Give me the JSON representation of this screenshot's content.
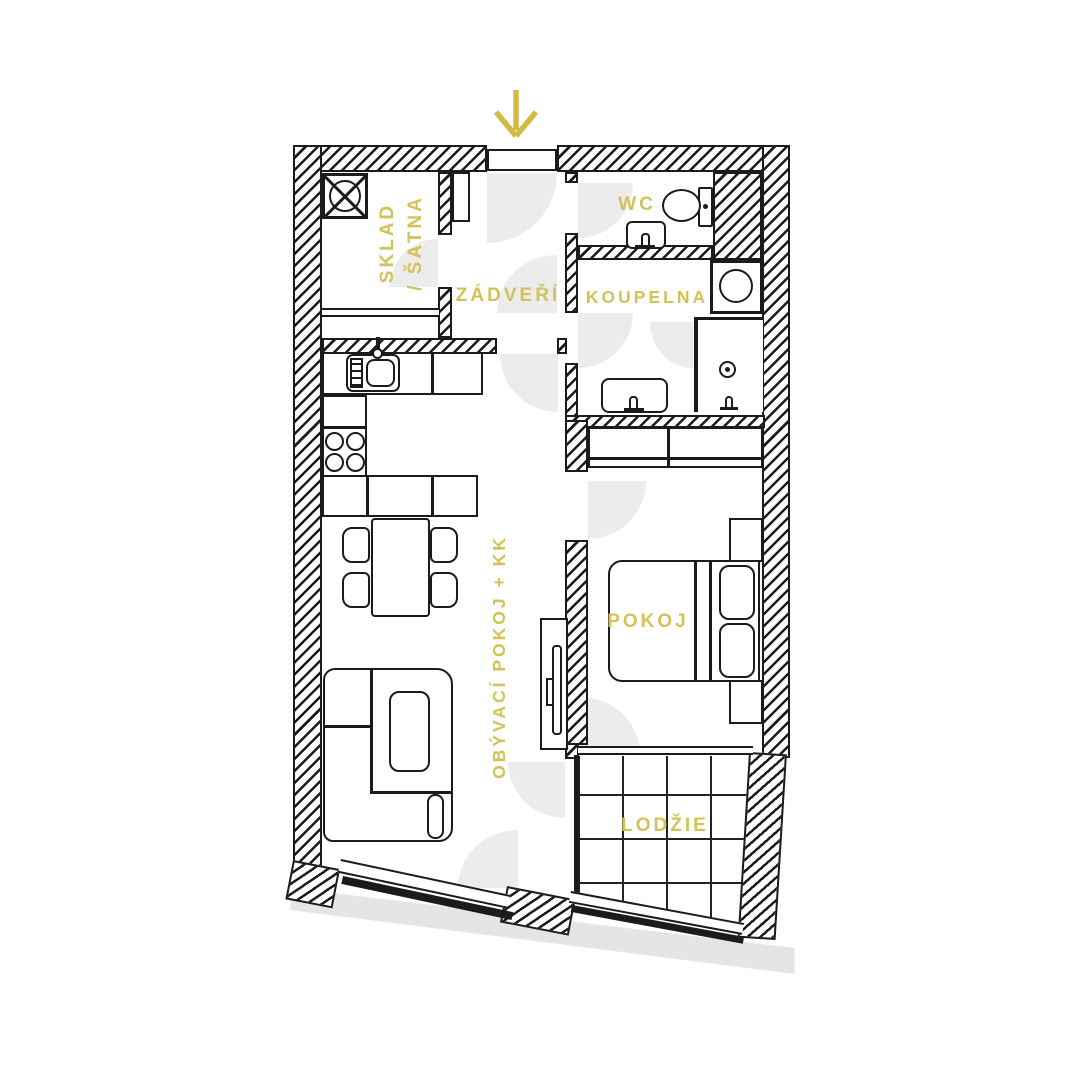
{
  "title": "apartment-floor-plan",
  "rooms": {
    "sklad": {
      "label_line1": "SKLAD",
      "label_line2": "/ ŠATNA"
    },
    "zadveri": {
      "label": "ZÁDVEŘÍ"
    },
    "wc": {
      "label": "WC"
    },
    "koupelna": {
      "label": "KOUPELNA"
    },
    "obyvaci_pokoj": {
      "label": "OBÝVACÍ POKOJ + KK"
    },
    "pokoj": {
      "label": "POKOJ"
    },
    "lodzie": {
      "label": "LODŽIE"
    }
  },
  "colors": {
    "label_text": "#d3c258",
    "entrance_arrow": "#d2bb45",
    "wall_line": "#1b1b1b",
    "door_swing": "#ececec",
    "shadow": "#e5e5e5"
  },
  "icons": {
    "entrance": "down-arrow-icon",
    "shaft": "crossed-circle-shaft-icon",
    "toilet": "toilet-icon",
    "wc_sink": "hand-basin-icon",
    "washing_machine": "washing-machine-icon",
    "shower_drain": "shower-drain-icon",
    "shower_tap": "shower-tap-icon",
    "bath_sink": "wash-basin-icon",
    "kitchen_sink": "kitchen-sink-icon",
    "stove": "four-burner-stove-icon"
  }
}
